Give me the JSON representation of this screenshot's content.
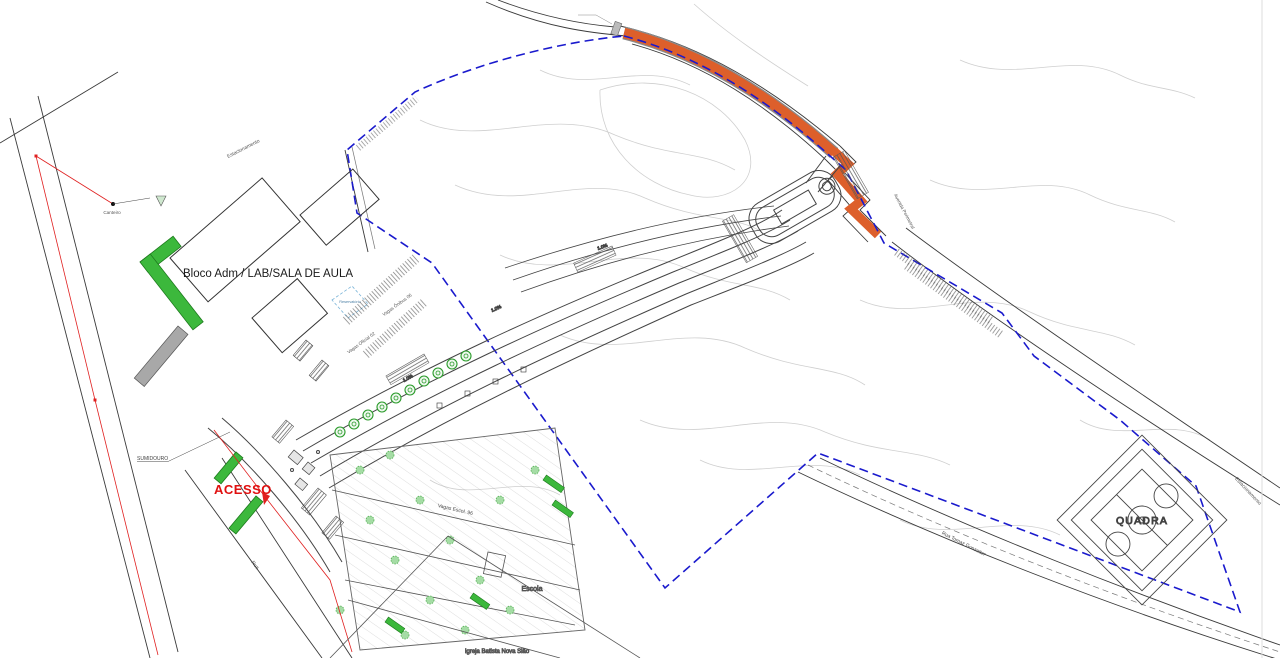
{
  "colors": {
    "background": "#ffffff",
    "new_road_highlight": "#DD5F2B",
    "property_boundary_blue": "#1A1ACD",
    "vegetation_green": "#3CB83C",
    "shrub_green": "#A5DCA5",
    "survey_red": "#E02020",
    "access_label_red": "#E01010",
    "contour_gray": "#CFCFCF",
    "line_dark": "#3A3A3A"
  },
  "labels": {
    "main_building": "Bloco Adm / LAB/SALA DE AULA",
    "access": "ACESSO",
    "court": "QUADRA",
    "school": "Escola",
    "church": "Igreja Batista Nova Sião",
    "soakaway": "SUMIDOURO",
    "planting_bed": "Canteiro",
    "reservoir": "Reservatório",
    "parking_top": "Estacionamento",
    "parking_right": "Estacionamento",
    "avenue": "Avenida Perimetral",
    "street_bottom": "Rua Tomaz Gonzatter",
    "street_left": "Rua",
    "bus_bays": "Vagas Ônibus 06",
    "official_bays": "Vagas Oficial 02",
    "school_bays": "Vagas Escol. 96",
    "slope_a": "1.0%",
    "slope_b": "1.0%",
    "slope_c": "1.0%"
  }
}
